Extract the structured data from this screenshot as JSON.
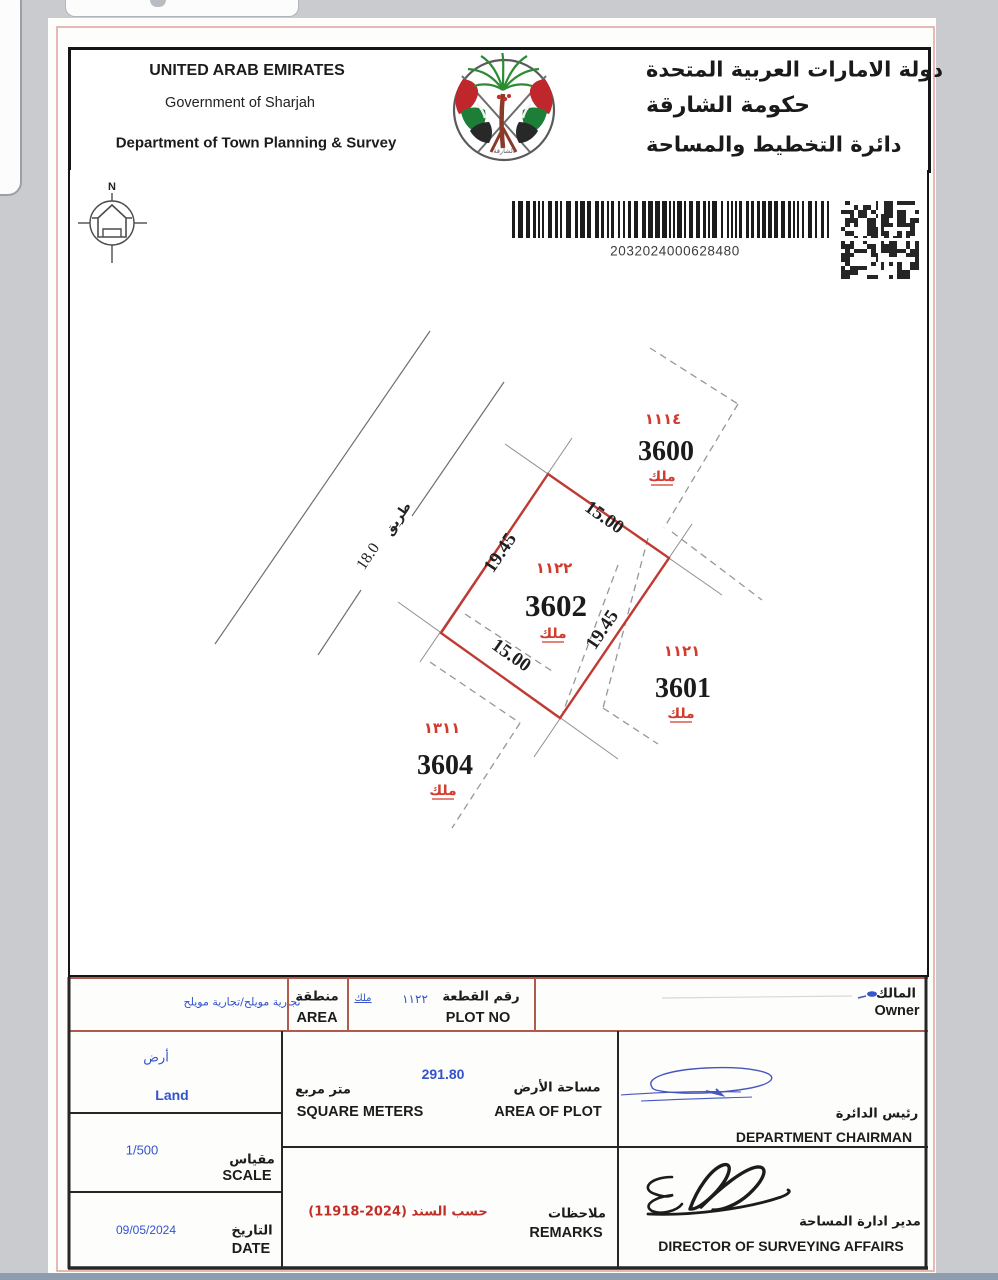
{
  "header": {
    "en1": "UNITED ARAB EMIRATES",
    "en2": "Government of Sharjah",
    "en3": "Department of Town Planning & Survey",
    "ar1": "دولة الامارات العربية المتحدة",
    "ar2": "حكومة الشارقة",
    "ar3": "دائرة التخطيط والمساحة",
    "emblem_caption_ar": "الشارقة"
  },
  "barcode": {
    "number": "2032024000628480"
  },
  "compass": {
    "north_label": "N"
  },
  "map": {
    "road": {
      "name_ar": "طريق",
      "width": "18.0"
    },
    "plot": {
      "number": "3602",
      "block_no_ar": "١١٢٢",
      "tenure_ar": "ملك",
      "dim_top": "15.00",
      "dim_left": "19.45",
      "dim_right": "19.45",
      "dim_bottom": "15.00"
    },
    "neighbors": [
      {
        "number": "3600",
        "block_no_ar": "١١١٤",
        "tenure_ar": "ملك"
      },
      {
        "number": "3601",
        "block_no_ar": "١١٢١",
        "tenure_ar": "ملك"
      },
      {
        "number": "3604",
        "block_no_ar": "١٣١١",
        "tenure_ar": "ملك"
      }
    ]
  },
  "table": {
    "area": {
      "value": "تجارية مويلح/تجارية مويلح",
      "label_ar": "منطقة",
      "label_en": "AREA"
    },
    "plot_no": {
      "tenure_ar": "ملك",
      "value_ar": "١١٢٢",
      "label_ar": "رقم القطعة",
      "label_en": "PLOT NO"
    },
    "owner": {
      "label_ar": "المالك",
      "label_en": "Owner"
    },
    "land": {
      "value_ar": "أرض",
      "value_en": "Land"
    },
    "plot_area": {
      "value": "291.80",
      "unit_ar": "متر مربع",
      "unit_en": "SQUARE METERS",
      "label_ar": "مساحة الأرض",
      "label_en": "AREA OF PLOT"
    },
    "chairman": {
      "label_ar": "رئيس الدائرة",
      "label_en": "DEPARTMENT CHAIRMAN"
    },
    "scale": {
      "value": "1/500",
      "label_ar": "مقياس",
      "label_en": "SCALE"
    },
    "date": {
      "value": "09/05/2024",
      "label_ar": "التاريخ",
      "label_en": "DATE"
    },
    "remarks": {
      "value_ar": "حسب السند (2024-11918)",
      "label_ar": "ملاحظات",
      "label_en": "REMARKS"
    },
    "director": {
      "label_ar": "مدير ادارة المساحة",
      "label_en": "DIRECTOR OF SURVEYING AFFAIRS"
    }
  },
  "colors": {
    "plot_outline": "#bf3a33",
    "red_text": "#d23b2e",
    "blue_value": "#3353cc",
    "row1_border": "#b05a50"
  }
}
